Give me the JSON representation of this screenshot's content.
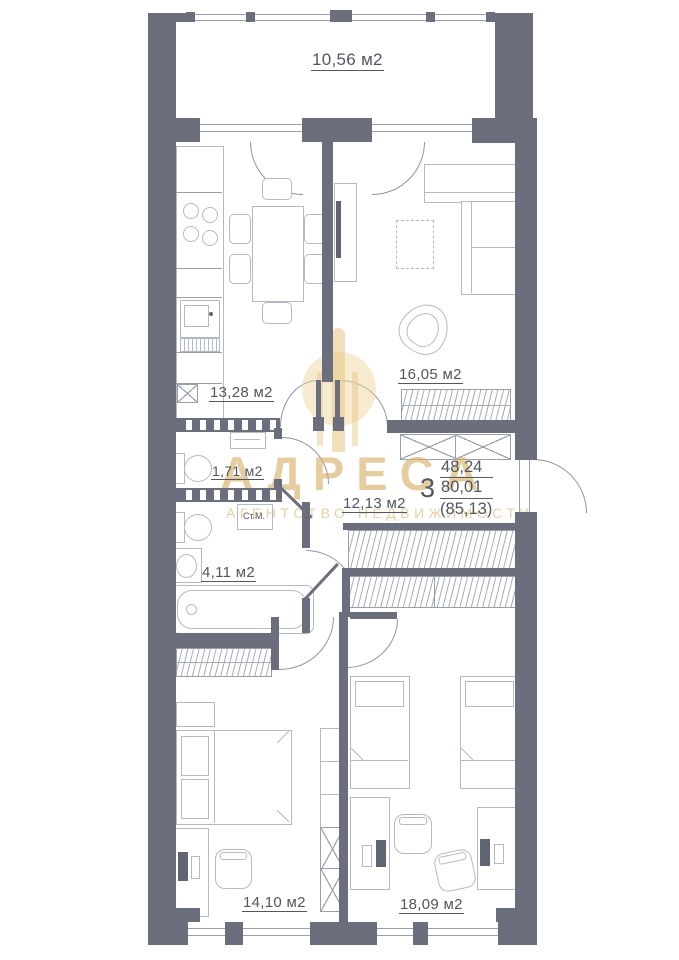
{
  "rooms": {
    "balcony": {
      "label": "10,56 м2"
    },
    "kitchen": {
      "label": "13,28 м2"
    },
    "living_room": {
      "label": "16,05 м2"
    },
    "wc": {
      "label": "1,71 м2"
    },
    "bathroom": {
      "label": "4,11 м2"
    },
    "hallway": {
      "label": "12,13 м2"
    },
    "bedroom_1": {
      "label": "14,10 м2"
    },
    "bedroom_2": {
      "label": "18,09 м2"
    }
  },
  "appliances": {
    "washing_machine": "Ст.М."
  },
  "summary": {
    "rooms_count": "3",
    "living_area": "48,24",
    "apartment_area": "80,01",
    "total_area": "(85,13)"
  },
  "watermark": {
    "name": "АДРЕСА",
    "tagline": "АГЕНТСТВО НЕДВИЖИМОСТИ"
  },
  "colors": {
    "wall": "#6a6e7d",
    "furniture_line": "#b4bac4",
    "text": "#51565f",
    "watermark_gold": "#d6ae64"
  }
}
